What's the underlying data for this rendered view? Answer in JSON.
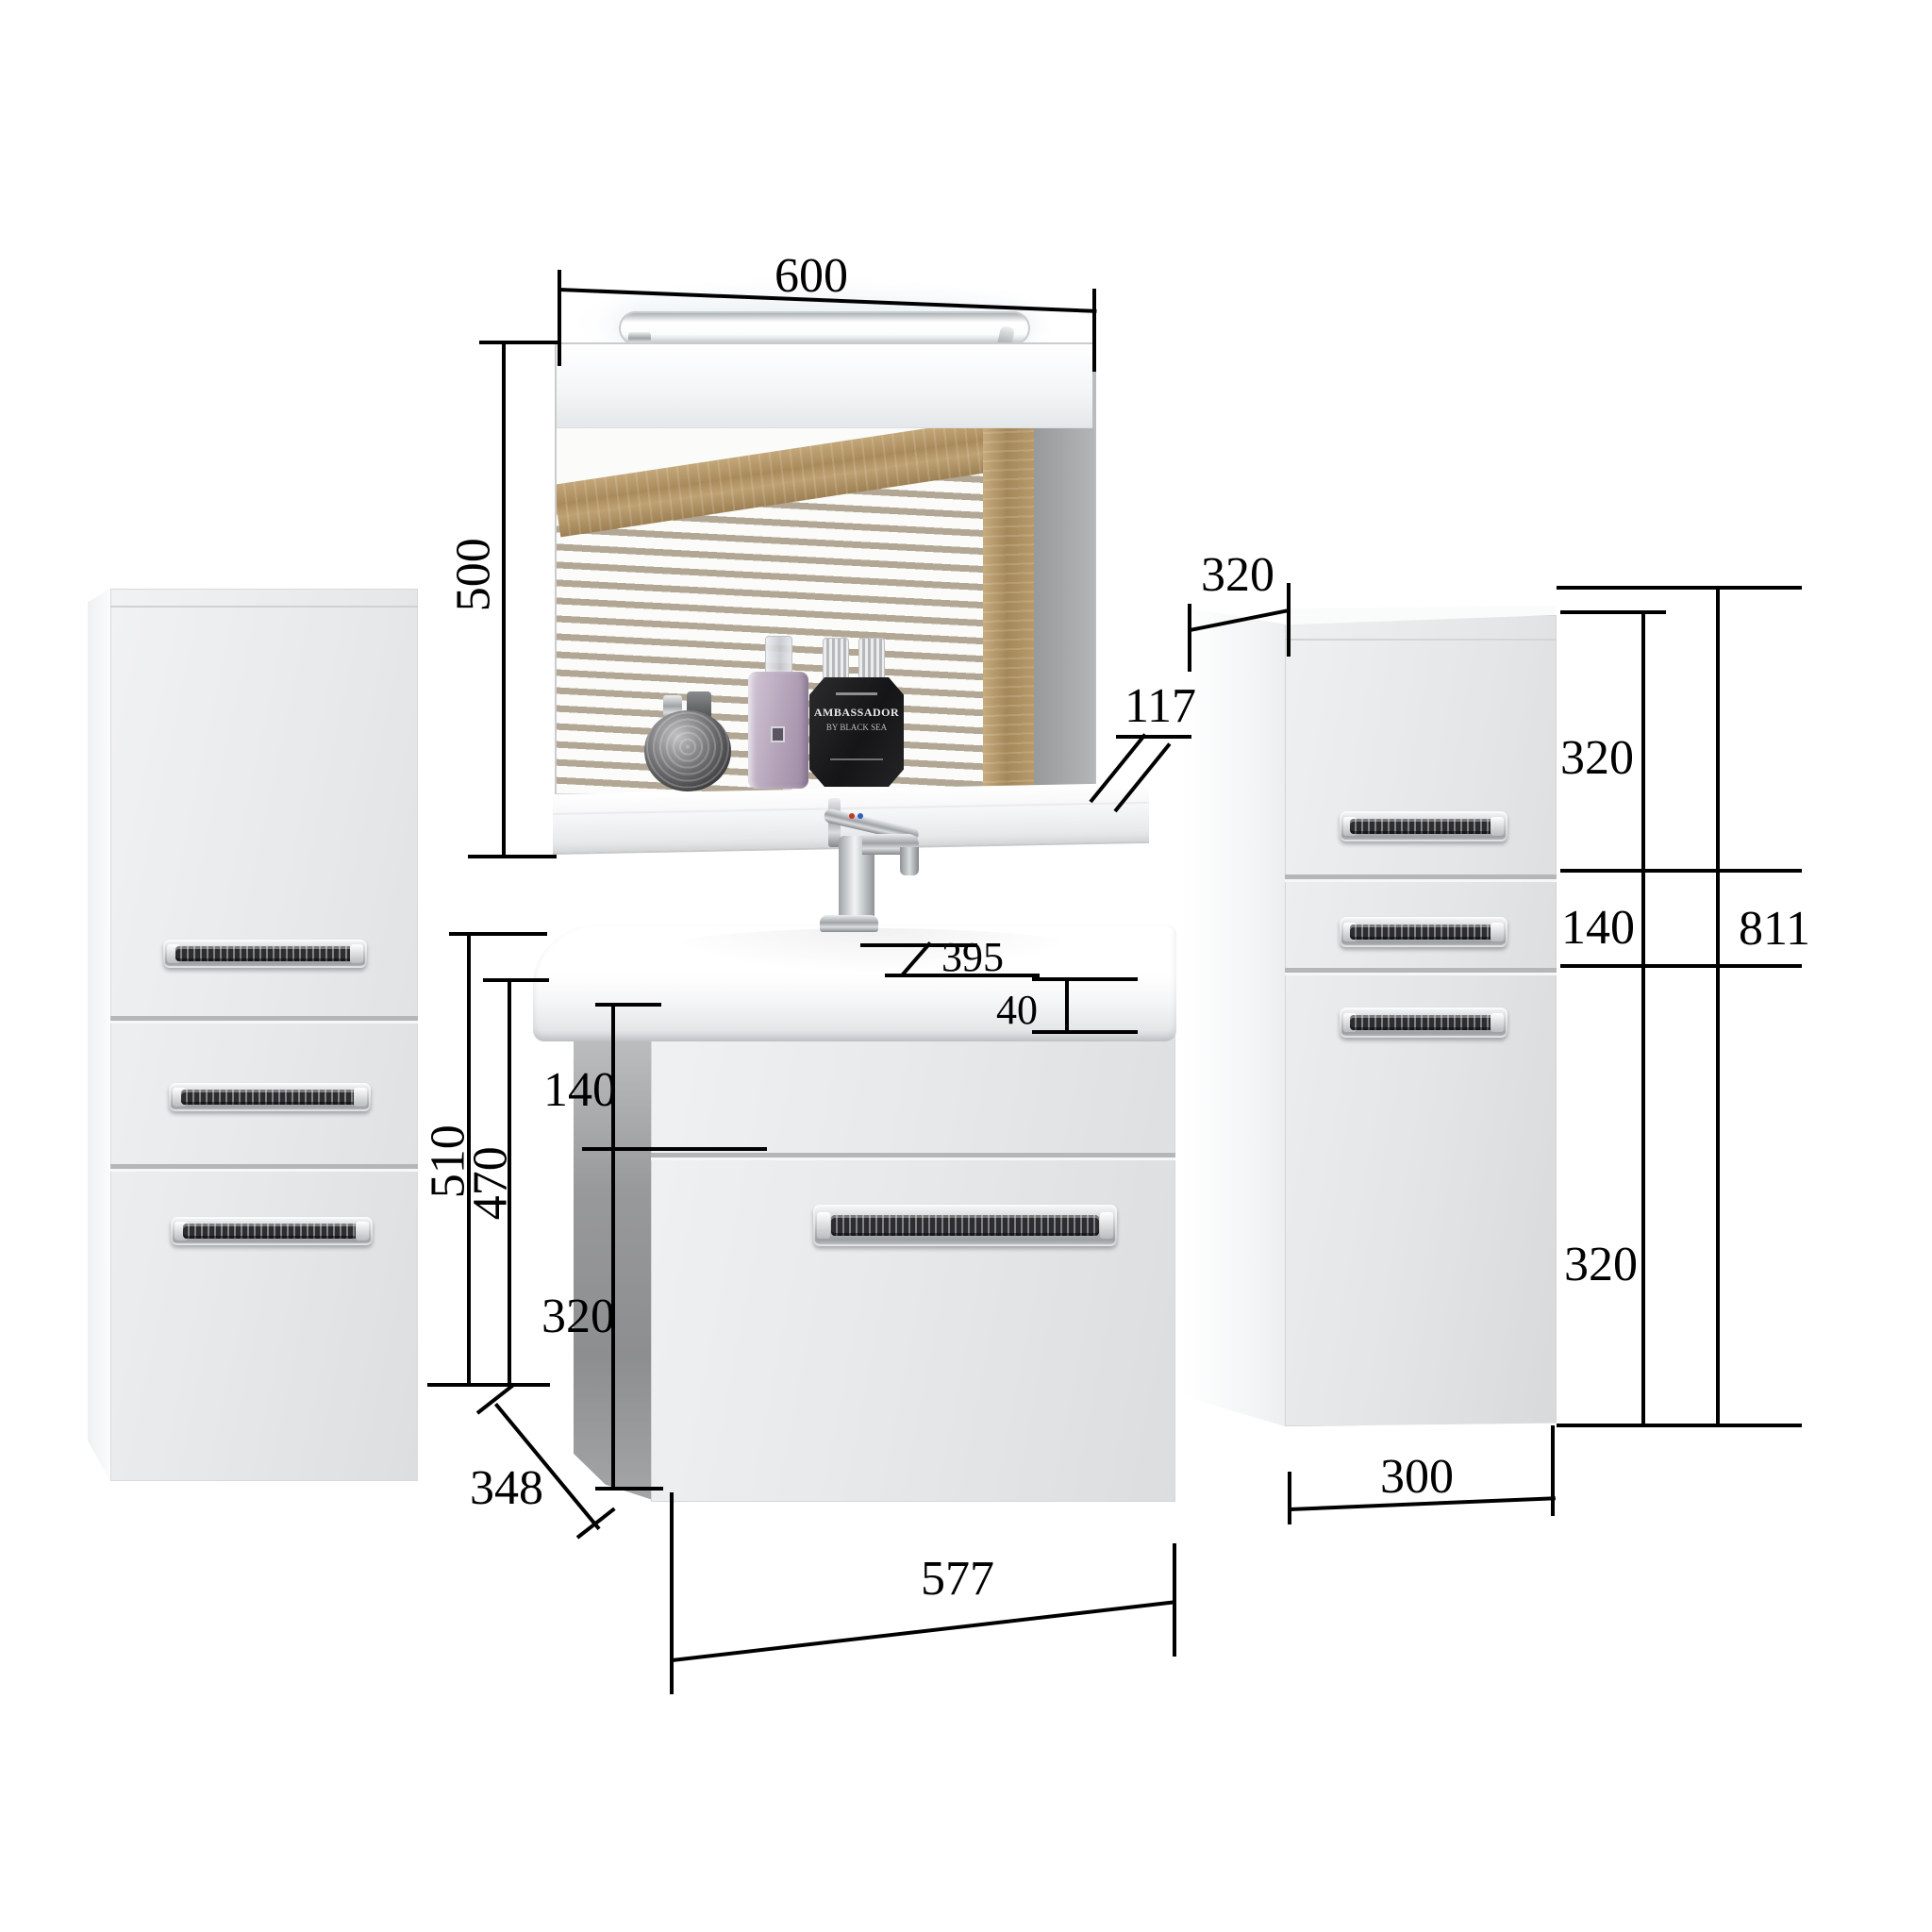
{
  "scene": {
    "description": "Bathroom furniture set dimension diagram: mirror with light, two side cabinets and washbasin vanity unit"
  },
  "dims": {
    "mirror_width": "600",
    "mirror_height": "500",
    "shelf_thickness": "117",
    "cabinet_depth": "320",
    "right_total": "811",
    "right_top": "320",
    "right_mid": "140",
    "right_bottom": "320",
    "right_width": "300",
    "vanity_total_height": "510",
    "vanity_body_height": "470",
    "vanity_top_drawer": "140",
    "vanity_bottom_drawer": "320",
    "basin_depth": "395",
    "basin_lip": "40",
    "vanity_depth": "348",
    "vanity_width": "577"
  },
  "flask": {
    "line1": "AMBASSADOR",
    "line2": "BY BLACK SEA"
  },
  "colors": {
    "dimension_line": "#000000",
    "cabinet_front": "#e4e6e8",
    "cabinet_side_light": "#f7f8f9",
    "vanity_side_dark": "#939496",
    "wood": "#ab8a5c",
    "wall_stripe": "#b3a896",
    "chrome": "#c9ccce",
    "flask_black": "#1b1b1d",
    "bottle_lavender": "#b4a3b9"
  }
}
